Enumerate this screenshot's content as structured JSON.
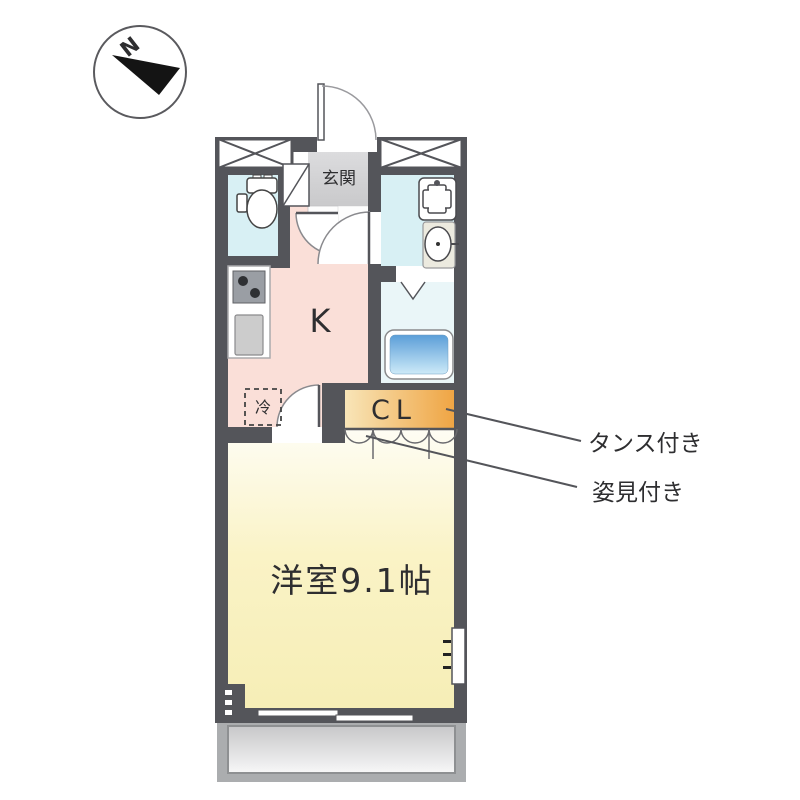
{
  "compass": {
    "north_label": "N"
  },
  "rooms": {
    "entrance": {
      "label": "玄関"
    },
    "kitchen": {
      "label": "K"
    },
    "fridge": {
      "label": "冷"
    },
    "closet": {
      "label": "CL"
    },
    "western_room": {
      "label": "洋室9.1帖"
    }
  },
  "annotations": {
    "tansu": {
      "label": "タンス付き"
    },
    "sugatami": {
      "label": "姿見付き"
    }
  },
  "colors": {
    "wall": "#54555a",
    "wet_area_cyan": "#d8f0f4",
    "kitchen_pink": "#fadfd8",
    "room_cream": "#f8f1bf",
    "closet_orange": "#efa544",
    "entrance_gray": "#d6d6d8",
    "bathtub_blue": "#5b9ed8",
    "balcony_gray": "#abadaf"
  }
}
